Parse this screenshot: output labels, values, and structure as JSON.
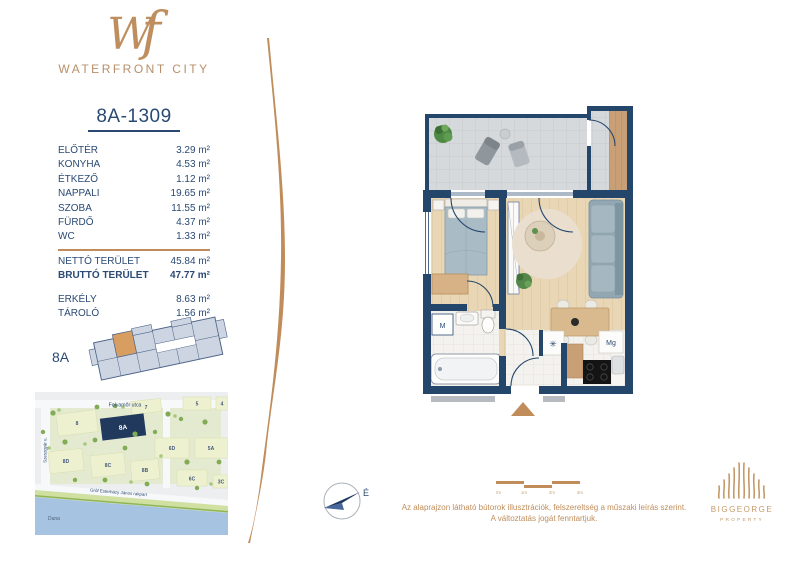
{
  "brand": {
    "monogram_w": "W",
    "monogram_f": "f",
    "name": "WATERFRONT CITY"
  },
  "unit": {
    "id": "8A-1309"
  },
  "areas": {
    "rooms": [
      {
        "label": "ELŐTÉR",
        "value": "3.29 m²"
      },
      {
        "label": "KONYHA",
        "value": "4.53 m²"
      },
      {
        "label": "ÉTKEZŐ",
        "value": "1.12 m²"
      },
      {
        "label": "NAPPALI",
        "value": "19.65 m²"
      },
      {
        "label": "SZOBA",
        "value": "11.55 m²"
      },
      {
        "label": "FÜRDŐ",
        "value": "4.37 m²"
      },
      {
        "label": "WC",
        "value": "1.33 m²"
      }
    ],
    "totals": [
      {
        "label": "NETTÓ TERÜLET",
        "value": "45.84 m²"
      },
      {
        "label": "BRUTTÓ TERÜLET",
        "value": "47.77 m²"
      }
    ],
    "extras": [
      {
        "label": "ERKÉLY",
        "value": "8.63 m²"
      },
      {
        "label": "TÁROLÓ",
        "value": "1.56 m²"
      }
    ]
  },
  "overview": {
    "label": "8A"
  },
  "map": {
    "street_top": "Folyamőr utca",
    "street_left": "Szeszgyár u.",
    "street_quay": "Gróf Esterházy János rakpart",
    "river": "Duna",
    "buildings": [
      "8",
      "8A",
      "7",
      "5",
      "4",
      "6D",
      "5A",
      "8D",
      "8C",
      "8B",
      "6C",
      "3C"
    ]
  },
  "floor_plan": {
    "washer": "M",
    "dishwasher": "Mg",
    "fridge": "✳"
  },
  "compass": {
    "north": "É"
  },
  "scale": {
    "ticks": [
      "0m",
      "1m",
      "2m",
      "3m"
    ]
  },
  "disclaimer": {
    "line1": "Az alaprajzon látható bútorok illusztrációk, felszereltség a műszaki leírás szerint.",
    "line2": "A változtatás jogát fenntartjuk."
  },
  "publisher": {
    "name": "BIGGEORGE",
    "division": "PROPERTY"
  }
}
